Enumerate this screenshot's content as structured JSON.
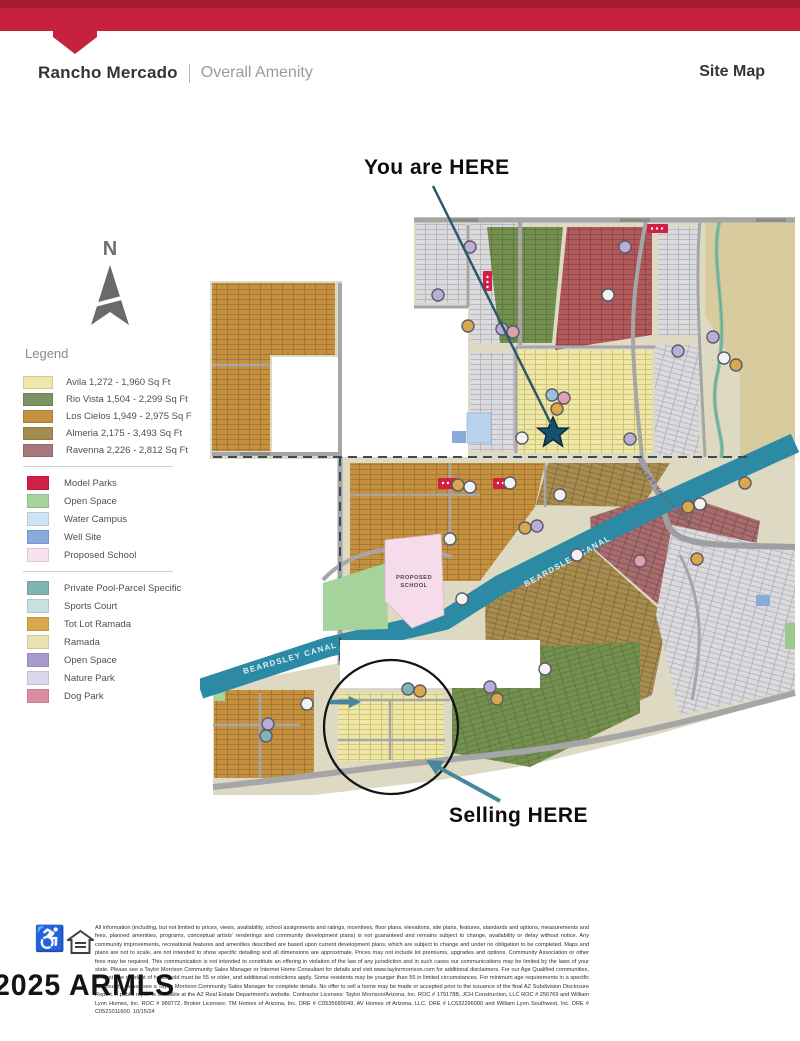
{
  "header": {
    "bar_color": "#c62240",
    "community_name": "Rancho Mercado",
    "subtitle": "Overall Amenity",
    "right_label": "Site Map"
  },
  "annotations": {
    "you_are_here": "You are HERE",
    "selling_here": "Selling HERE",
    "north_label": "N"
  },
  "legend": {
    "title": "Legend",
    "communities": [
      {
        "label": "Avila 1,272 - 1,960 Sq Ft",
        "color": "#efe8a8"
      },
      {
        "label": "Rio Vista 1,504 - 2,299 Sq Ft",
        "color": "#7d9365"
      },
      {
        "label": "Los Cielos 1,949 - 2,975 Sq F",
        "color": "#c3913f"
      },
      {
        "label": "Almeria 2,175 - 3,493 Sq Ft",
        "color": "#a38b53"
      },
      {
        "label": "Ravenna 2,226 - 2,812 Sq Ft",
        "color": "#a5787c"
      }
    ],
    "land_use": [
      {
        "label": "Model Parks",
        "color": "#d21f45"
      },
      {
        "label": "Open Space",
        "color": "#a6d29c"
      },
      {
        "label": "Water Campus",
        "color": "#cfe3f4"
      },
      {
        "label": "Well Site",
        "color": "#86abdc"
      },
      {
        "label": "Proposed School",
        "color": "#f8e0ec"
      }
    ],
    "amenities": [
      {
        "label": "Private Pool-Parcel Specific",
        "color": "#7fb3b4"
      },
      {
        "label": "Sports Court",
        "color": "#c8e0e0"
      },
      {
        "label": "Tot Lot Ramada",
        "color": "#d8a74e"
      },
      {
        "label": "Ramada",
        "color": "#ecdfb4"
      },
      {
        "label": "Open Space",
        "color": "#a79bcb"
      },
      {
        "label": "Nature Park",
        "color": "#dcd7ea"
      },
      {
        "label": "Dog Park",
        "color": "#d88fa0"
      }
    ]
  },
  "map": {
    "labels": {
      "proposed_school_line1": "PROPOSED",
      "proposed_school_line2": "SCHOOL",
      "beardsley_canal": "BEARDSLEY CANAL",
      "happy_valley_road": "HAPPY VALLEY ROAD"
    },
    "colors": {
      "canal": "#2d8aa5",
      "road": "#a6a6a8",
      "desert": "#d8cc9e",
      "land": "#ded9c3",
      "star": "#15506e"
    }
  },
  "footer": {
    "watermark": "2025 ARMLS",
    "disclaimer": "All information (including, but not limited to prices, views, availability, school assignments and ratings, incentives, floor plans, elevations, site plans, features, standards and options, measurements and fees, planned amenities, programs, conceptual artists' renderings and community development plans) is not guaranteed and remains subject to change, availability or delay without notice. Any community improvements, recreational features and amenities described are based upon current development plans, which are subject to change and under no obligation to be completed. Maps and plans are not to scale, are not intended to show specific detailing and all dimensions are approximate. Prices may not include lot premiums, upgrades and options. Community Association or other fees may be required. This communication is not intended to constitute an offering in violation of the law of any jurisdiction and in such cases our communications may be limited by the laws of your state. Please see a Taylor Morrison Community Sales Manager or Internet Home Consultant for details and visit www.taylormorrison.com for additional disclaimers. For our Age Qualified communities, at least one resident of household must be 55 or older, and additional restrictions apply. Some residents may be younger than 55 in limited circumstances. For minimum age requirements in a specific community, please see a Taylor Morrison Community Sales Manager for complete details. No offer to sell a home may be made or accepted prior to the issuance of the final AZ Subdivision Disclosure Report. A public report is available at the AZ Real Estate Department's website. Contractor Licenses: Taylor Morrison/Arizona, Inc. ROC # 179178B, JCH Construction, LLC ROC # 256769 and William Lyon Homes, Inc. ROC # 98977Z. Broker Licenses: TM Homes of Arizona, Inc. DRE # C0535689049, AV Homes of Arizona, LLC. DRE # LC632296000 and William Lyon Southwest, Inc. DRE # C0521011600. 10/15/24"
  }
}
